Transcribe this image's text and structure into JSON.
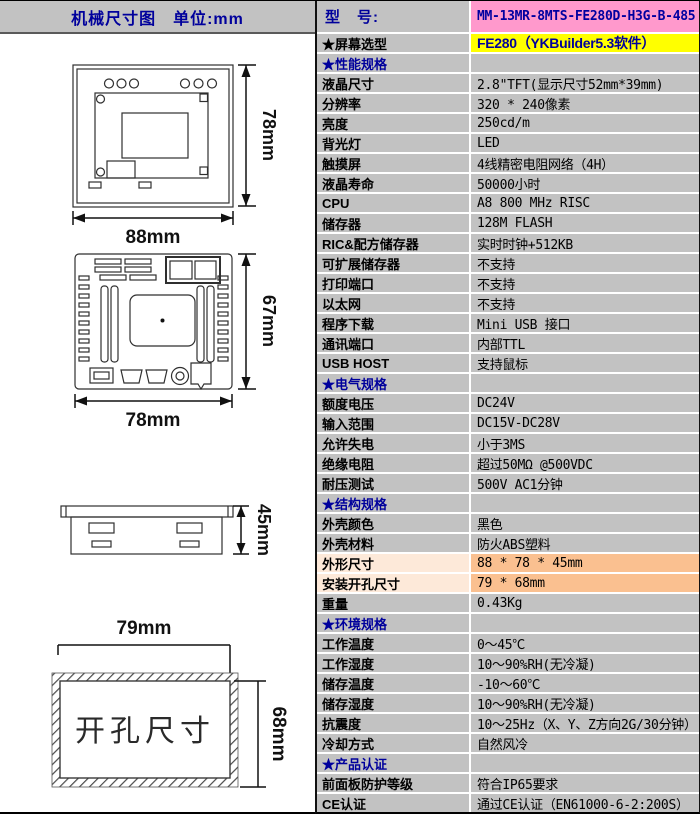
{
  "left_panel": {
    "title": "机械尺寸图　单位:mm"
  },
  "drawings": {
    "front_view": {
      "width_label": "88mm",
      "height_label": "78mm"
    },
    "back_view": {
      "width_label": "78mm",
      "height_label": "67mm"
    },
    "side_view": {
      "height_label": "45mm"
    },
    "cutout": {
      "width_label": "79mm",
      "height_label": "68mm",
      "caption": "开孔尺寸"
    }
  },
  "colors": {
    "table_gray": "#C2C2C2",
    "model_pink": "#FF99CC",
    "screen_yellow": "#FFFF00",
    "orange_label": "#FDE9D9",
    "orange_value": "#FAC090",
    "heading_navy": "#00009C"
  },
  "spec_table": {
    "rows": [
      {
        "label": "型　号:",
        "value": "MM-13MR-8MTS-FE280D-H3G-B-485",
        "type": "model"
      },
      {
        "label": "★屏幕选型",
        "value": "FE280（YKBuilder5.3软件）",
        "type": "screen"
      },
      {
        "label": "★性能规格",
        "value": "",
        "type": "section"
      },
      {
        "label": "液晶尺寸",
        "value": "2.8\"TFT(显示尺寸52mm*39mm)",
        "type": "normal"
      },
      {
        "label": "分辨率",
        "value": "320 * 240像素",
        "type": "normal"
      },
      {
        "label": "亮度",
        "value": "250cd/m",
        "type": "normal"
      },
      {
        "label": "背光灯",
        "value": "LED",
        "type": "normal"
      },
      {
        "label": "触摸屏",
        "value": "4线精密电阻网络（4H）",
        "type": "normal"
      },
      {
        "label": "液晶寿命",
        "value": "50000小时",
        "type": "normal"
      },
      {
        "label": "CPU",
        "value": "A8 800 MHz RISC",
        "type": "normal"
      },
      {
        "label": "储存器",
        "value": "128M FLASH",
        "type": "normal"
      },
      {
        "label": "RIC&配方储存器",
        "value": "实时时钟+512KB",
        "type": "normal"
      },
      {
        "label": "可扩展储存器",
        "value": "不支持",
        "type": "normal"
      },
      {
        "label": "打印端口",
        "value": "不支持",
        "type": "normal"
      },
      {
        "label": "以太网",
        "value": "不支持",
        "type": "normal"
      },
      {
        "label": "程序下载",
        "value": "Mini USB 接口",
        "type": "normal"
      },
      {
        "label": "通讯端口",
        "value": "内部TTL",
        "type": "normal"
      },
      {
        "label": "USB HOST",
        "value": "支持鼠标",
        "type": "normal"
      },
      {
        "label": "★电气规格",
        "value": "",
        "type": "section"
      },
      {
        "label": "额度电压",
        "value": "DC24V",
        "type": "normal"
      },
      {
        "label": "输入范围",
        "value": "DC15V-DC28V",
        "type": "normal"
      },
      {
        "label": "允许失电",
        "value": "小于3MS",
        "type": "normal"
      },
      {
        "label": "绝缘电阻",
        "value": "超过50MΩ @500VDC",
        "type": "normal"
      },
      {
        "label": "耐压测试",
        "value": "500V AC1分钟",
        "type": "normal"
      },
      {
        "label": "★结构规格",
        "value": "",
        "type": "section"
      },
      {
        "label": "外壳颜色",
        "value": "黑色",
        "type": "normal"
      },
      {
        "label": "外壳材料",
        "value": "防火ABS塑料",
        "type": "normal"
      },
      {
        "label": "外形尺寸",
        "value": "88 * 78 * 45mm",
        "type": "orange"
      },
      {
        "label": "安装开孔尺寸",
        "value": "79 * 68mm",
        "type": "orange"
      },
      {
        "label": "重量",
        "value": "0.43Kg",
        "type": "normal"
      },
      {
        "label": "★环境规格",
        "value": "",
        "type": "section"
      },
      {
        "label": "工作温度",
        "value": "0～45℃",
        "type": "normal"
      },
      {
        "label": "工作湿度",
        "value": "10～90%RH(无冷凝)",
        "type": "normal"
      },
      {
        "label": "储存温度",
        "value": "-10～60℃",
        "type": "normal"
      },
      {
        "label": "储存湿度",
        "value": "10～90%RH(无冷凝)",
        "type": "normal"
      },
      {
        "label": "抗震度",
        "value": "10～25Hz（X、Y、Z方向2G/30分钟）",
        "type": "normal"
      },
      {
        "label": "冷却方式",
        "value": "自然风冷",
        "type": "normal"
      },
      {
        "label": "★产品认证",
        "value": "",
        "type": "section"
      },
      {
        "label": "前面板防护等级",
        "value": "符合IP65要求",
        "type": "normal"
      },
      {
        "label": "CE认证",
        "value": "通过CE认证（EN61000-6-2:200S）",
        "type": "normal"
      }
    ]
  }
}
